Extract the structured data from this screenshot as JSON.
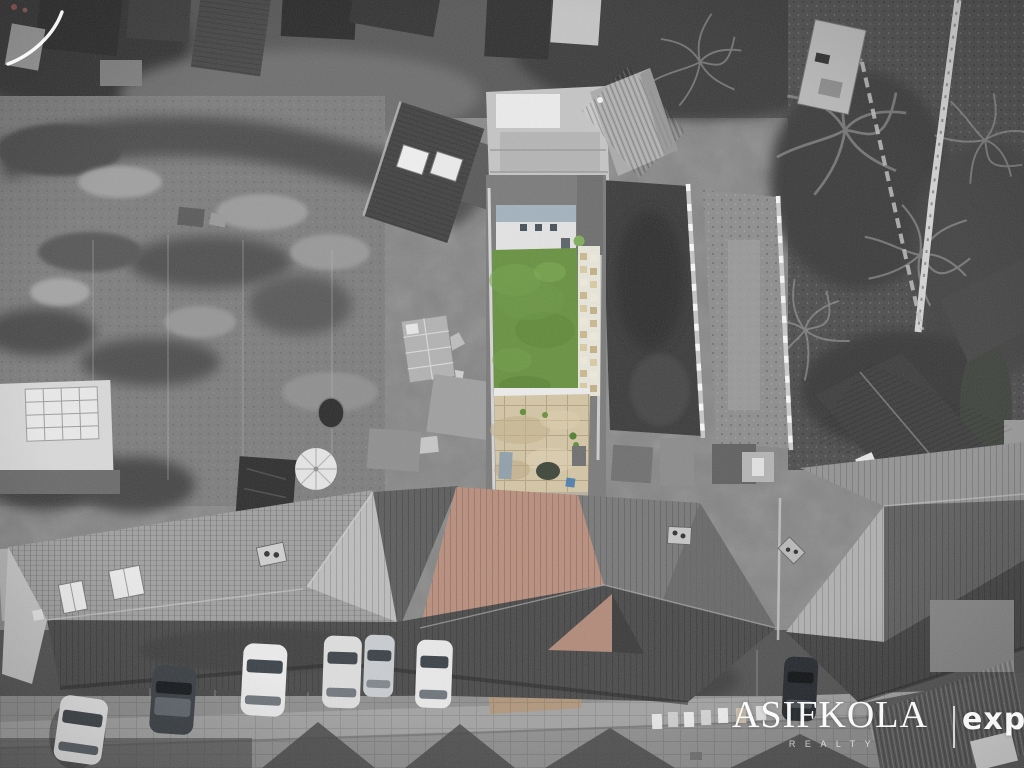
{
  "meta": {
    "type": "aerial-drone-photograph",
    "treatment": "black-and-white photo with selective colour highlighting the featured property's garden and roof"
  },
  "watermark": {
    "brand": "ASIFKOLA",
    "tagline": "REALTY",
    "partner_logo": "exp"
  },
  "palette": {
    "lawn_green": "#67913f",
    "lawn_light": "#78a44c",
    "patio_beige": "#d4c6a5",
    "roof_terracotta": "#b98e7d",
    "street_tan": "#b1977a",
    "mono_base": "#858585",
    "watermark_white": "#ffffff"
  },
  "scene": {
    "focus": "rear garden of terraced house with bright green lawn, stepping-stone path and sandstone patio",
    "elements": [
      "terraced house roofs",
      "rear gardens",
      "garden walls with coping",
      "bare winter trees",
      "parked cars",
      "block-paved street",
      "patio umbrella",
      "greenhouse",
      "garden sheds",
      "chimneys",
      "skylights"
    ],
    "visible_car_count": "7"
  }
}
